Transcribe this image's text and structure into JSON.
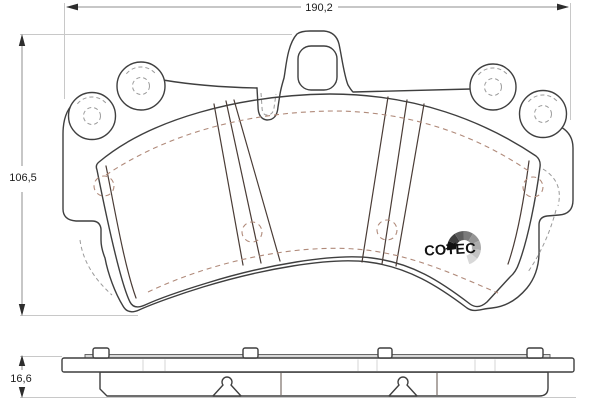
{
  "dimensions": {
    "width": "190,2",
    "height": "106,5",
    "thickness": "16,6"
  },
  "logo": {
    "text": "COTEC"
  },
  "colors": {
    "pad": "#f4b29e",
    "outline": "#3f3f3f",
    "dimension_line": "#8f8f8f",
    "extension_line": "#c8c8c8",
    "label_text": "#1c1c1c",
    "shim_strip": "#d9d9d9",
    "logo_fan": [
      "#141414",
      "#3d3d3d",
      "#5d5d5d",
      "#7b7b7b",
      "#959595",
      "#acacac",
      "#c3c3c3",
      "#d8d8d8"
    ]
  }
}
